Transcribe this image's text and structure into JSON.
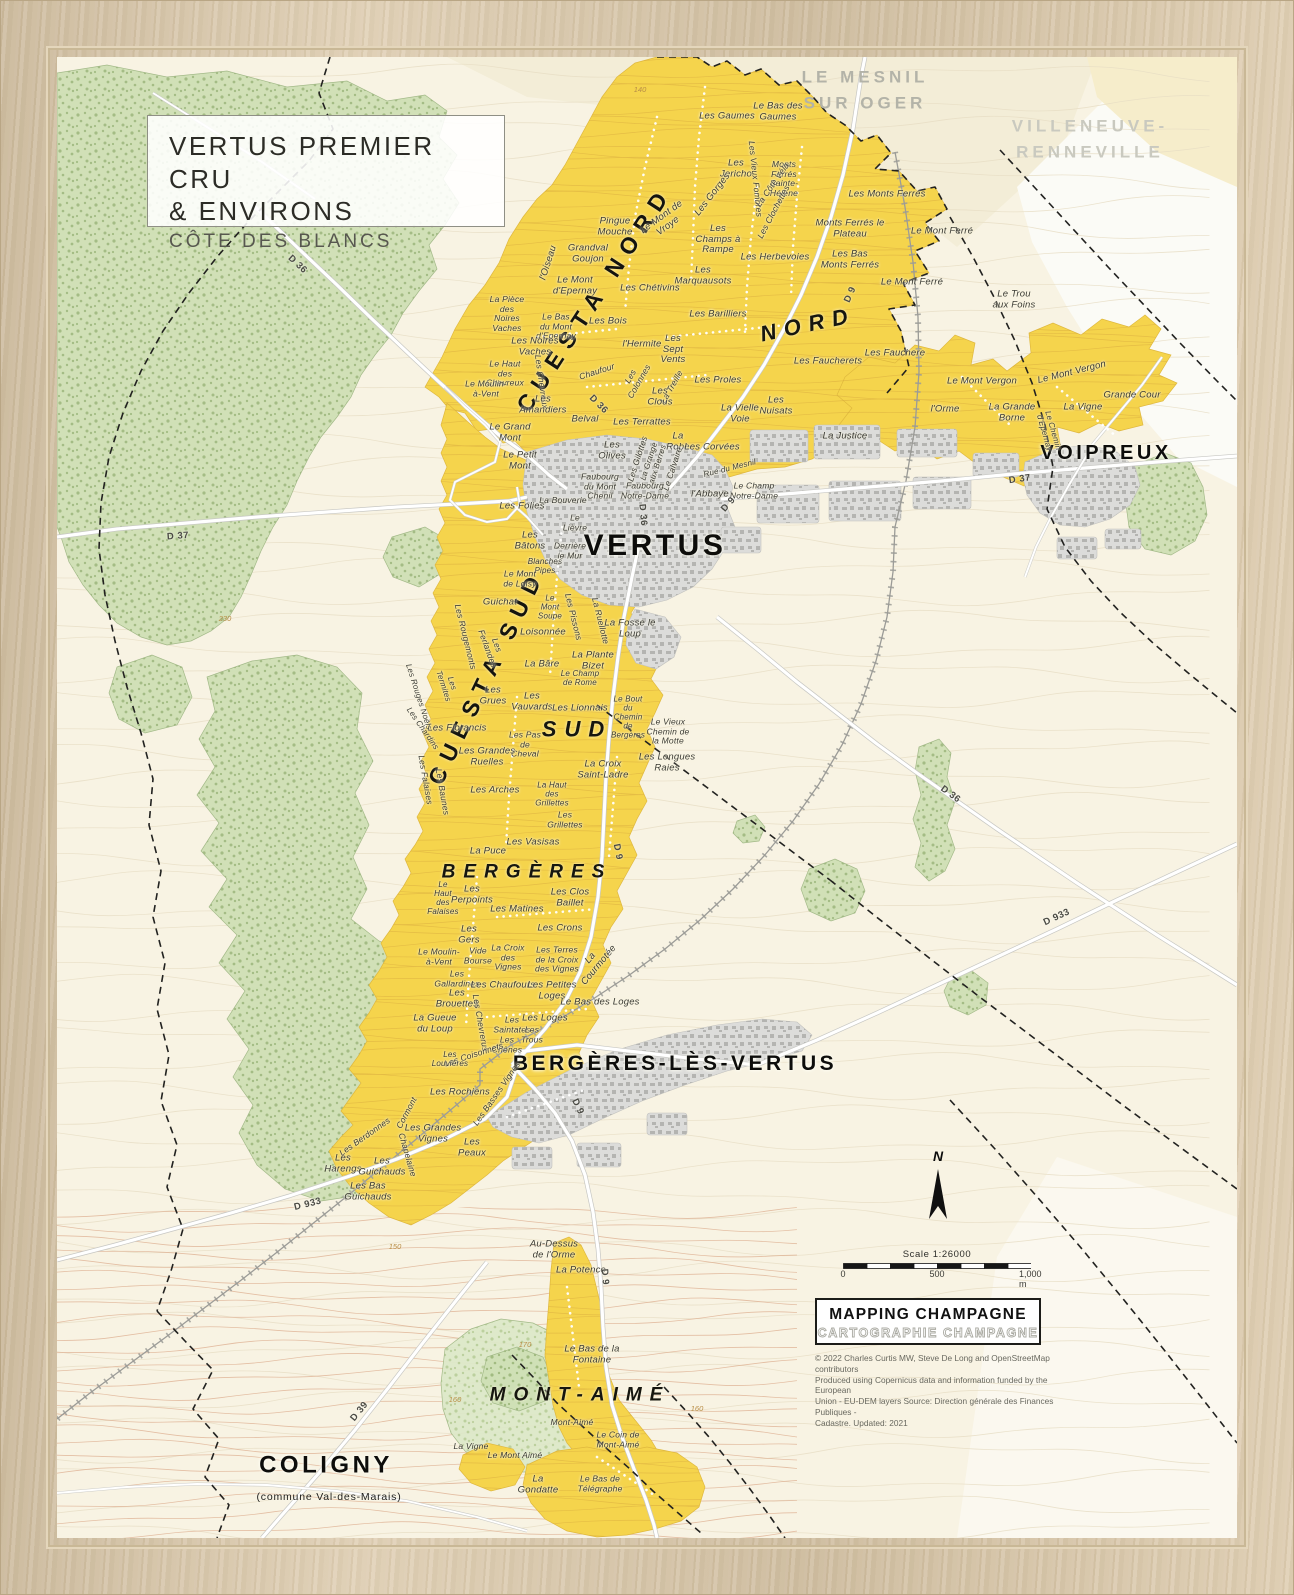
{
  "title_box": {
    "line1": "VERTUS PREMIER CRU",
    "line2": "& ENVIRONS",
    "line3": "CÔTE DES BLANCS"
  },
  "legend": {
    "scale_text": "Scale 1:26000",
    "scale_ticks": [
      "0",
      "500",
      "1,000  m"
    ],
    "logo_line1": "MAPPING CHAMPAGNE",
    "logo_line2": "CARTOGRAPHIE CHAMPAGNE",
    "copyright": [
      "© 2022 Charles Curtis MW, Steve De Long and OpenStreetMap contributors",
      "Produced using Copernicus data and information funded by the European",
      "Union - EU-DEM layers Source: Direction générale des Finances Publiques -",
      "Cadastre. Updated: 2021"
    ],
    "north_label": "N"
  },
  "colors": {
    "vineyard": "#f5d44c",
    "forest": "#cfe0b5",
    "forest_light": "#dde9c9",
    "urban": "#dcdcda",
    "paper": "#f8f3e3",
    "road": "#ffffff",
    "frame_wood": "#d8c6a8",
    "boundary": "#1f1f1d",
    "contour_vine": "#d5a63e"
  },
  "map": {
    "labels": [
      {
        "t": "LE MESNIL\nSUR OGER",
        "x": 808,
        "y": 33,
        "c": "gray1"
      },
      {
        "t": "VILLENEUVE-\nRENNEVILLE",
        "x": 1033,
        "y": 82,
        "c": "gray2"
      },
      {
        "t": "CUESTA NORD",
        "x": 538,
        "y": 242,
        "r": -57,
        "c": "cuesta"
      },
      {
        "t": "NORD",
        "x": 751,
        "y": 268,
        "r": -12,
        "c": "region",
        "s": 22
      },
      {
        "t": "CUESTA SUD",
        "x": 430,
        "y": 620,
        "r": -64,
        "c": "cuesta"
      },
      {
        "t": "SUD",
        "x": 520,
        "y": 673,
        "c": "region",
        "s": 22
      },
      {
        "t": "BERGÈRES",
        "x": 470,
        "y": 815,
        "c": "region",
        "s": 19
      },
      {
        "t": "MONT-AIMÉ",
        "x": 523,
        "y": 1338,
        "c": "region",
        "s": 19
      },
      {
        "t": "VERTUS",
        "x": 598,
        "y": 489,
        "c": "town",
        "s": 30
      },
      {
        "t": "VOIPREUX",
        "x": 1049,
        "y": 396,
        "c": "town",
        "s": 20
      },
      {
        "t": "BERGÈRES-LÈS-VERTUS",
        "x": 618,
        "y": 1007,
        "c": "town",
        "s": 21
      },
      {
        "t": "COLIGNY",
        "x": 269,
        "y": 1409,
        "c": "town",
        "s": 24
      },
      {
        "t": "(commune Val-des-Marais)",
        "x": 272,
        "y": 1441,
        "c": "town-sub"
      },
      {
        "t": "Les Gaumes",
        "x": 670,
        "y": 60
      },
      {
        "t": "Le Bas des\nGaumes",
        "x": 721,
        "y": 55
      },
      {
        "t": "Monts\nFerrés\nSainte-\nHélène",
        "x": 727,
        "y": 122,
        "s": 8.5
      },
      {
        "t": "Monts Ferrés le\nPlateau",
        "x": 793,
        "y": 172
      },
      {
        "t": "Les Monts Ferrés",
        "x": 830,
        "y": 138
      },
      {
        "t": "Les\nJericho",
        "x": 679,
        "y": 112
      },
      {
        "t": "Les Gorges",
        "x": 656,
        "y": 138,
        "r": -52
      },
      {
        "t": "Les Vieux Fombres",
        "x": 698,
        "y": 122,
        "r": 84,
        "s": 8.5
      },
      {
        "t": "La Côte Véla",
        "x": 716,
        "y": 128,
        "r": -55,
        "s": 8.5
      },
      {
        "t": "Les Clochettes",
        "x": 717,
        "y": 155,
        "r": -62,
        "s": 8.5
      },
      {
        "t": "Le Mont de\nVroye",
        "x": 608,
        "y": 165,
        "r": -36
      },
      {
        "t": "Les\nChamps à\nRampe",
        "x": 661,
        "y": 183
      },
      {
        "t": "Les Herbevoies",
        "x": 718,
        "y": 201
      },
      {
        "t": "Les\nMarquausots",
        "x": 646,
        "y": 219
      },
      {
        "t": "Les Chétivins",
        "x": 593,
        "y": 232
      },
      {
        "t": "Grandval\nGoujon",
        "x": 531,
        "y": 197
      },
      {
        "t": "Pingue\nMouche",
        "x": 558,
        "y": 170
      },
      {
        "t": "l'Oiseau",
        "x": 492,
        "y": 206,
        "r": -72
      },
      {
        "t": "Le Mont\nd'Epernay",
        "x": 518,
        "y": 229
      },
      {
        "t": "La Pièce\ndes\nNoires\nVaches",
        "x": 450,
        "y": 257,
        "s": 8.5
      },
      {
        "t": "Le Bas\ndu Mont\nd'Epernay",
        "x": 499,
        "y": 270,
        "s": 8.5
      },
      {
        "t": "Les Noires\nVaches",
        "x": 478,
        "y": 290
      },
      {
        "t": "Le Haut\ndes\nChevreux",
        "x": 448,
        "y": 317,
        "s": 8.5
      },
      {
        "t": "Les Chevreux",
        "x": 484,
        "y": 325,
        "r": 82,
        "s": 8.5
      },
      {
        "t": "Chaufour",
        "x": 540,
        "y": 315,
        "r": -18,
        "s": 8.5
      },
      {
        "t": "Le Moulin-\nà-Vent",
        "x": 429,
        "y": 332,
        "s": 8.5
      },
      {
        "t": "Les\nAmandiers",
        "x": 486,
        "y": 348
      },
      {
        "t": "Belval",
        "x": 528,
        "y": 363
      },
      {
        "t": "Le Grand\nMont",
        "x": 453,
        "y": 376
      },
      {
        "t": "Le Petit\nMont",
        "x": 463,
        "y": 404
      },
      {
        "t": "Les Bois",
        "x": 551,
        "y": 265
      },
      {
        "t": "l'Hermite",
        "x": 585,
        "y": 288
      },
      {
        "t": "Les\nSept\nVents",
        "x": 616,
        "y": 293
      },
      {
        "t": "Les Barilliers",
        "x": 661,
        "y": 258
      },
      {
        "t": "Les Proles",
        "x": 661,
        "y": 324
      },
      {
        "t": "Les\nColonnes",
        "x": 578,
        "y": 322,
        "r": -60,
        "s": 8.5
      },
      {
        "t": "La Treille",
        "x": 615,
        "y": 330,
        "r": -60,
        "s": 8.5
      },
      {
        "t": "Les Terrattes",
        "x": 585,
        "y": 366
      },
      {
        "t": "Les\nClous",
        "x": 603,
        "y": 340
      },
      {
        "t": "La\nRobe",
        "x": 621,
        "y": 385
      },
      {
        "t": "Les Corvées",
        "x": 655,
        "y": 391
      },
      {
        "t": "Les\nOlives",
        "x": 555,
        "y": 394
      },
      {
        "t": "Les Gilottes",
        "x": 581,
        "y": 402,
        "r": -72,
        "s": 8.5
      },
      {
        "t": "La Grange\naux Berres",
        "x": 597,
        "y": 406,
        "r": -72,
        "s": 8
      },
      {
        "t": "Le Calvaire",
        "x": 616,
        "y": 412,
        "r": -72,
        "s": 8.5
      },
      {
        "t": "Faubourg\ndu Mont\nChenil",
        "x": 543,
        "y": 430,
        "s": 8.5
      },
      {
        "t": "Faubourg\nNotre-Dame",
        "x": 588,
        "y": 434,
        "s": 8.5
      },
      {
        "t": "La Bouverie",
        "x": 506,
        "y": 444,
        "s": 8.5
      },
      {
        "t": "l'Abbaye",
        "x": 653,
        "y": 438
      },
      {
        "t": "Le Champ\nNotre-Dame",
        "x": 697,
        "y": 434,
        "s": 8.5
      },
      {
        "t": "Rue du Mesnil",
        "x": 673,
        "y": 412,
        "r": -14,
        "s": 8
      },
      {
        "t": "La Justice",
        "x": 788,
        "y": 380
      },
      {
        "t": "La Vielle\nVoie",
        "x": 683,
        "y": 357
      },
      {
        "t": "Les\nNuisats",
        "x": 719,
        "y": 349
      },
      {
        "t": "Les Faucherets",
        "x": 771,
        "y": 305
      },
      {
        "t": "Les Fauchere",
        "x": 838,
        "y": 297
      },
      {
        "t": "Le Mont Ferré",
        "x": 885,
        "y": 175
      },
      {
        "t": "Le Mont Ferré",
        "x": 855,
        "y": 226
      },
      {
        "t": "Les Bas\nMonts Ferrés",
        "x": 793,
        "y": 203
      },
      {
        "t": "Le Trou\naux Foins",
        "x": 957,
        "y": 243
      },
      {
        "t": "Le Mont Vergon",
        "x": 925,
        "y": 325
      },
      {
        "t": "Le Mont Vergon",
        "x": 1015,
        "y": 316,
        "r": -14
      },
      {
        "t": "Grande Cour",
        "x": 1075,
        "y": 339
      },
      {
        "t": "l'Orme",
        "x": 888,
        "y": 353
      },
      {
        "t": "La Grande\nBorne",
        "x": 955,
        "y": 356
      },
      {
        "t": "La Vigne",
        "x": 1026,
        "y": 351
      },
      {
        "t": "Le Chemin\nd'Epernay",
        "x": 991,
        "y": 375,
        "r": 74,
        "s": 8
      },
      {
        "t": "Les Folies",
        "x": 465,
        "y": 450
      },
      {
        "t": "Le\nLièvre",
        "x": 518,
        "y": 466,
        "s": 8.5
      },
      {
        "t": "Les\nBâtons",
        "x": 473,
        "y": 484
      },
      {
        "t": "Derrière\nle Mur",
        "x": 513,
        "y": 494,
        "s": 8.5
      },
      {
        "t": "Blanches\nPipes",
        "x": 488,
        "y": 510,
        "s": 8
      },
      {
        "t": "Le Mont\nde Loisy",
        "x": 463,
        "y": 522,
        "s": 8.5
      },
      {
        "t": "Guichat",
        "x": 443,
        "y": 546
      },
      {
        "t": "Le\nMont\nSoupe",
        "x": 493,
        "y": 551,
        "s": 8
      },
      {
        "t": "Loisonnée",
        "x": 486,
        "y": 576
      },
      {
        "t": "Les Pissons",
        "x": 516,
        "y": 560,
        "r": 76,
        "s": 8.5
      },
      {
        "t": "La Ruellotte",
        "x": 543,
        "y": 564,
        "r": 76,
        "s": 8.5
      },
      {
        "t": "La Fosse le\nLoup",
        "x": 573,
        "y": 572
      },
      {
        "t": "La Plante\nBizet",
        "x": 536,
        "y": 604
      },
      {
        "t": "Le Champ\nde Rome",
        "x": 523,
        "y": 622,
        "s": 8
      },
      {
        "t": "La Bâre",
        "x": 485,
        "y": 608
      },
      {
        "t": "Les\nGrues",
        "x": 436,
        "y": 639
      },
      {
        "t": "Les\nVauvards",
        "x": 475,
        "y": 645
      },
      {
        "t": "Les Lionnais",
        "x": 523,
        "y": 652
      },
      {
        "t": "Les Florancis",
        "x": 400,
        "y": 672
      },
      {
        "t": "Les Pas\nde\nCheval",
        "x": 468,
        "y": 688,
        "s": 8.5
      },
      {
        "t": "Les Grandes\nRuelles",
        "x": 430,
        "y": 700
      },
      {
        "t": "Les Rougemonts",
        "x": 408,
        "y": 580,
        "r": 76,
        "s": 8.5
      },
      {
        "t": "Les\nFerlandes",
        "x": 435,
        "y": 590,
        "r": 70,
        "s": 8.5
      },
      {
        "t": "Les Rouges Noëls",
        "x": 361,
        "y": 640,
        "r": 72,
        "s": 8
      },
      {
        "t": "Les\nTermites",
        "x": 390,
        "y": 628,
        "r": 72,
        "s": 8
      },
      {
        "t": "Les Chardins",
        "x": 365,
        "y": 672,
        "r": 55,
        "s": 8
      },
      {
        "t": "La Croix\nSaint-Ladre",
        "x": 546,
        "y": 713
      },
      {
        "t": "Les Longues\nRaies",
        "x": 610,
        "y": 706
      },
      {
        "t": "Le Vieux\nChemin de\nla Motte",
        "x": 611,
        "y": 675,
        "s": 8.5
      },
      {
        "t": "Le Bout\ndu\nChemin\nde\nBergères",
        "x": 571,
        "y": 661,
        "s": 8
      },
      {
        "t": "Les Falaises",
        "x": 368,
        "y": 723,
        "r": 80,
        "s": 8.5
      },
      {
        "t": "Les Baunes",
        "x": 385,
        "y": 735,
        "r": 80,
        "s": 8.5
      },
      {
        "t": "Les Arches",
        "x": 438,
        "y": 734
      },
      {
        "t": "La Haut\ndes\nGrillettes",
        "x": 495,
        "y": 738,
        "s": 8
      },
      {
        "t": "Les\nGrillettes",
        "x": 508,
        "y": 763,
        "s": 8.5
      },
      {
        "t": "Les Vasisas",
        "x": 476,
        "y": 786
      },
      {
        "t": "La Puce",
        "x": 431,
        "y": 795
      },
      {
        "t": "Le\nHaut\ndes\nFalaises",
        "x": 386,
        "y": 842,
        "s": 8
      },
      {
        "t": "Les\nPerpoints",
        "x": 415,
        "y": 838
      },
      {
        "t": "Les Matines",
        "x": 460,
        "y": 853
      },
      {
        "t": "Les Clos\nBaillet",
        "x": 513,
        "y": 841
      },
      {
        "t": "Les Crons",
        "x": 503,
        "y": 872
      },
      {
        "t": "Les\nGers",
        "x": 412,
        "y": 878
      },
      {
        "t": "Le Moulin-\nà-Vent",
        "x": 382,
        "y": 900,
        "s": 8.5
      },
      {
        "t": "Vide\nBourse",
        "x": 421,
        "y": 899,
        "s": 8.5
      },
      {
        "t": "La Croix\ndes\nVignes",
        "x": 451,
        "y": 901,
        "s": 8.5
      },
      {
        "t": "Les Terres\nde la Croix\ndes Vignes",
        "x": 500,
        "y": 903,
        "s": 8.5
      },
      {
        "t": "La\nCourmotée",
        "x": 538,
        "y": 905,
        "r": -50
      },
      {
        "t": "Les\nGallardines",
        "x": 400,
        "y": 922,
        "s": 8.5
      },
      {
        "t": "Les Chaufours",
        "x": 446,
        "y": 929
      },
      {
        "t": "Les Petites\nLoges",
        "x": 495,
        "y": 934
      },
      {
        "t": "Les\nBrouettes",
        "x": 400,
        "y": 942
      },
      {
        "t": "Le Bas des Loges",
        "x": 543,
        "y": 946
      },
      {
        "t": "La Gueue\ndu Loup",
        "x": 378,
        "y": 967
      },
      {
        "t": "Les Chevrerus",
        "x": 423,
        "y": 966,
        "r": 80,
        "s": 8.5
      },
      {
        "t": "Les\nSaintates",
        "x": 455,
        "y": 968,
        "s": 8.5
      },
      {
        "t": "Les Loges",
        "x": 488,
        "y": 962
      },
      {
        "t": "Les\nTrous",
        "x": 475,
        "y": 978,
        "s": 8.5
      },
      {
        "t": "Les\nChênes",
        "x": 450,
        "y": 988,
        "s": 8.5
      },
      {
        "t": "Les Coisonnets",
        "x": 417,
        "y": 998,
        "r": -18,
        "s": 8.5
      },
      {
        "t": "Les\nLouvières",
        "x": 393,
        "y": 1003,
        "s": 8
      },
      {
        "t": "Les Rochiens",
        "x": 403,
        "y": 1036
      },
      {
        "t": "Les Basses Vignes",
        "x": 440,
        "y": 1037,
        "r": -55,
        "s": 8.5
      },
      {
        "t": "Les Berdonnes",
        "x": 308,
        "y": 1080,
        "r": -35,
        "s": 8.5
      },
      {
        "t": "Cormont",
        "x": 350,
        "y": 1056,
        "r": -62,
        "s": 8.5
      },
      {
        "t": "Les Grandes\nVignes",
        "x": 376,
        "y": 1077
      },
      {
        "t": "Chapelaine",
        "x": 350,
        "y": 1098,
        "r": 74,
        "s": 8.5
      },
      {
        "t": "Les\nPeaux",
        "x": 415,
        "y": 1091
      },
      {
        "t": "Les\nHarengs",
        "x": 286,
        "y": 1107
      },
      {
        "t": "Les\nGuichauds",
        "x": 325,
        "y": 1110
      },
      {
        "t": "Les Bas\nGuichauds",
        "x": 311,
        "y": 1135
      },
      {
        "t": "Au-Dessus\nde l'Orme",
        "x": 497,
        "y": 1193
      },
      {
        "t": "La Potence",
        "x": 524,
        "y": 1214
      },
      {
        "t": "Le Bas de la\nFontaine",
        "x": 535,
        "y": 1298
      },
      {
        "t": "Mont-Aimé",
        "x": 515,
        "y": 1366,
        "s": 8.5
      },
      {
        "t": "Le Coin de\nMont-Aimé",
        "x": 561,
        "y": 1383,
        "s": 8.5
      },
      {
        "t": "La Vigne",
        "x": 414,
        "y": 1390,
        "s": 8.5
      },
      {
        "t": "Le Mont Aimé",
        "x": 458,
        "y": 1399,
        "s": 8.5
      },
      {
        "t": "La\nGondatte",
        "x": 481,
        "y": 1428
      },
      {
        "t": "Le Bas de\nTélégraphe",
        "x": 543,
        "y": 1427,
        "s": 8.5
      },
      {
        "t": "D 36",
        "x": 541,
        "y": 348,
        "r": 45,
        "c": "road"
      },
      {
        "t": "D 36",
        "x": 585,
        "y": 458,
        "r": 85,
        "c": "road"
      },
      {
        "t": "D 36",
        "x": 240,
        "y": 208,
        "r": 43,
        "c": "road"
      },
      {
        "t": "D 36",
        "x": 893,
        "y": 738,
        "r": 36,
        "c": "road"
      },
      {
        "t": "D 37",
        "x": 121,
        "y": 480,
        "r": -4,
        "c": "road"
      },
      {
        "t": "D 37",
        "x": 963,
        "y": 423,
        "r": -8,
        "c": "road"
      },
      {
        "t": "D 9",
        "x": 794,
        "y": 238,
        "r": -66,
        "c": "road"
      },
      {
        "t": "D 9",
        "x": 672,
        "y": 448,
        "r": -49,
        "c": "road"
      },
      {
        "t": "D 9",
        "x": 560,
        "y": 795,
        "r": 79,
        "c": "road"
      },
      {
        "t": "D 9",
        "x": 520,
        "y": 1050,
        "r": 65,
        "c": "road"
      },
      {
        "t": "D 9",
        "x": 547,
        "y": 1220,
        "r": 85,
        "c": "road"
      },
      {
        "t": "D 933",
        "x": 251,
        "y": 1148,
        "r": -14,
        "c": "road"
      },
      {
        "t": "D 933",
        "x": 1000,
        "y": 861,
        "r": -25,
        "c": "road"
      },
      {
        "t": "D 39",
        "x": 303,
        "y": 1355,
        "r": -51,
        "c": "road"
      },
      {
        "t": "230",
        "x": 168,
        "y": 562,
        "c": "contour"
      },
      {
        "t": "150",
        "x": 338,
        "y": 1190,
        "c": "contour"
      },
      {
        "t": "160",
        "x": 398,
        "y": 1343,
        "c": "contour"
      },
      {
        "t": "170",
        "x": 468,
        "y": 1288,
        "c": "contour"
      },
      {
        "t": "140",
        "x": 583,
        "y": 33,
        "c": "contour"
      },
      {
        "t": "160",
        "x": 640,
        "y": 1352,
        "c": "contour"
      },
      {
        "t": "N",
        "x": 881,
        "y": 1100,
        "c": "north"
      }
    ]
  }
}
